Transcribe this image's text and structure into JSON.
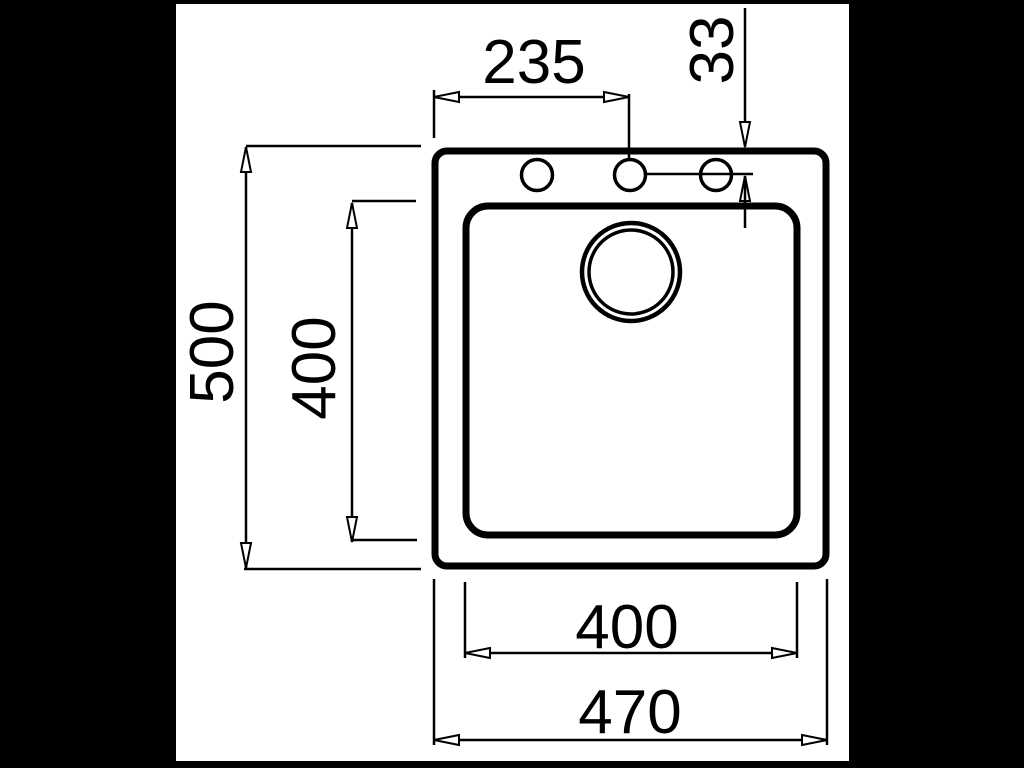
{
  "diagram": {
    "kind": "technical-dimension-drawing",
    "subject": "sink-top-view",
    "colors": {
      "background": "#000000",
      "paper": "#ffffff",
      "ink": "#000000"
    },
    "dimensions": {
      "faucet_centerline_from_left": "235",
      "faucet_hole_offset": "33",
      "overall_depth": "500",
      "bowl_depth": "400",
      "bowl_width": "400",
      "overall_width": "470"
    }
  }
}
